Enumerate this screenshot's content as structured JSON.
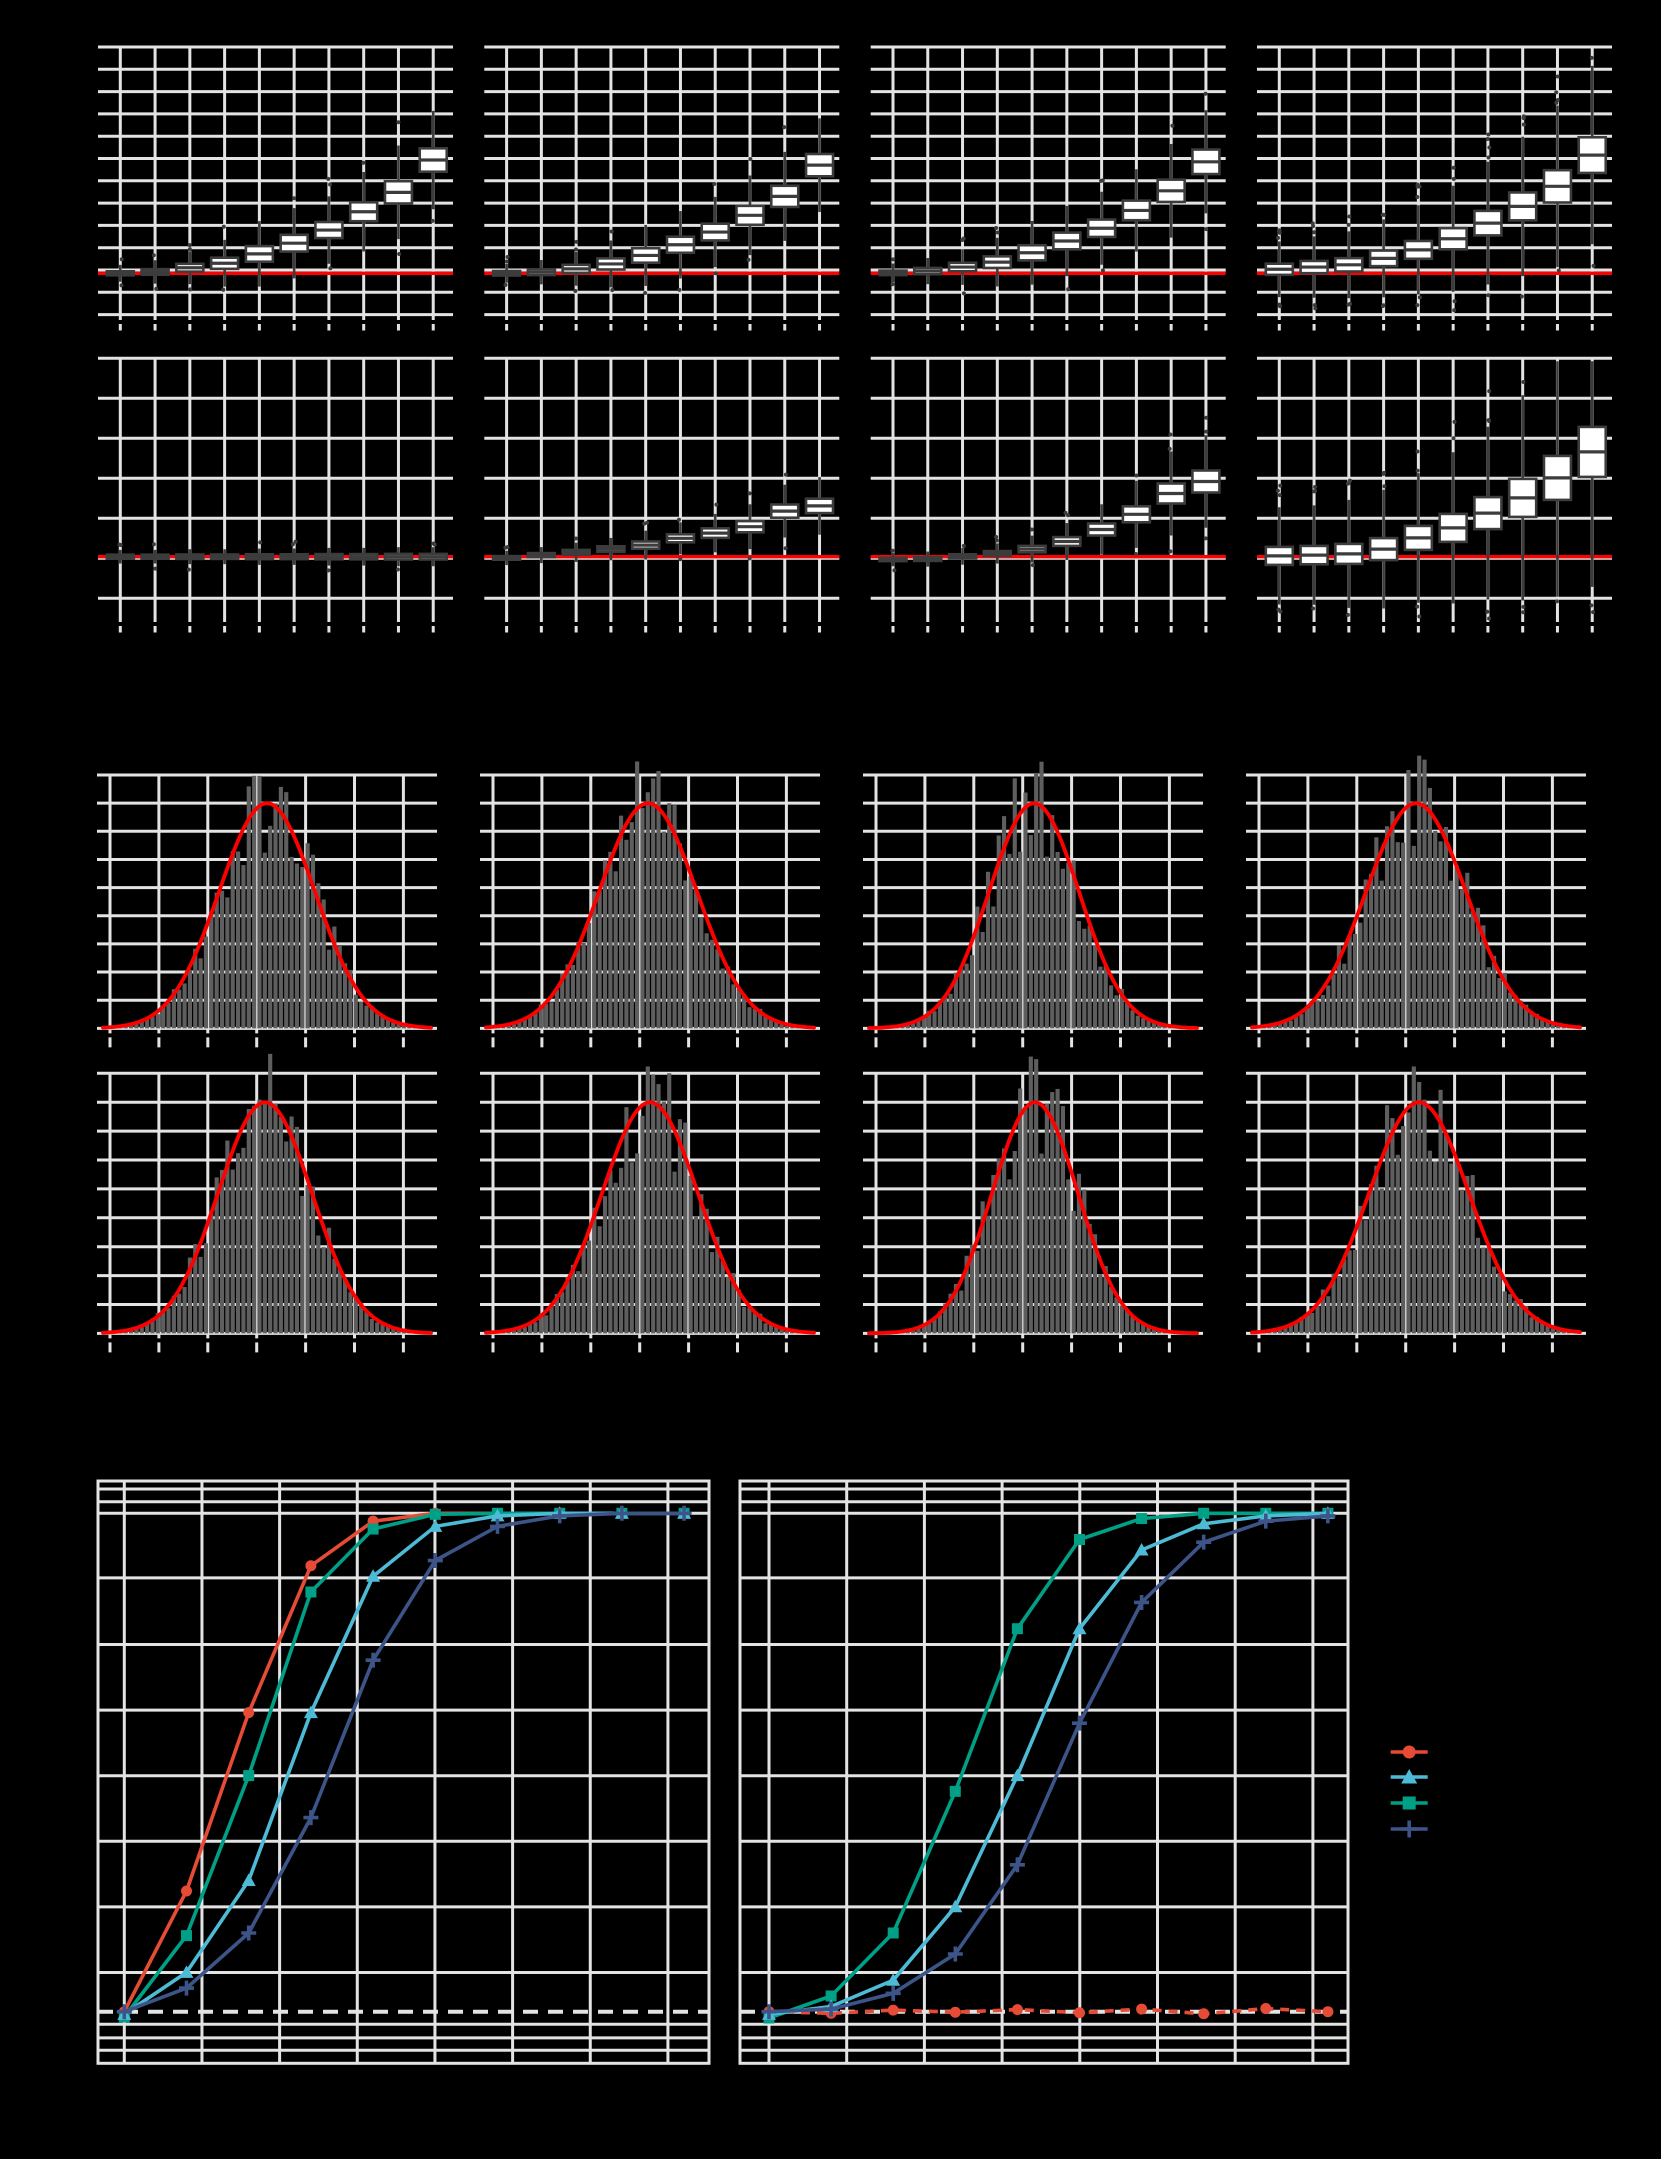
{
  "figure": {
    "background": "#000000",
    "grid_color": "#E3E3E3",
    "reference_red": "#FF0000",
    "box_stroke": "#3C3C3C",
    "box_fill": "#FFFFFF",
    "hist_fill": "#5E5E5E",
    "dashed_reference_color": "#E3E3E3"
  },
  "legend": {
    "position": "right of second power panel",
    "items": [
      {
        "name": "series-red-circle",
        "marker": "circle",
        "color": "#E64B35"
      },
      {
        "name": "series-cyan-triangle",
        "marker": "triangle",
        "color": "#4DBBD5"
      },
      {
        "name": "series-teal-square",
        "marker": "square",
        "color": "#00A087"
      },
      {
        "name": "series-navy-plus",
        "marker": "plus",
        "color": "#3C5488"
      }
    ]
  },
  "chart_data": [
    {
      "type": "table",
      "note": "boxplot facet grid 2x4; y units are panel grid divisions relative to the red reference line (axis text not visible in image)",
      "categories": [
        1,
        2,
        3,
        4,
        5,
        6,
        7,
        8,
        9,
        10
      ],
      "reference_line": 0,
      "panels": [
        {
          "row": 1,
          "col": 1,
          "median": [
            0,
            0.06,
            0.25,
            0.45,
            0.87,
            1.35,
            1.94,
            2.76,
            3.63,
            5.08
          ],
          "iqr": [
            0.18,
            0.25,
            0.35,
            0.5,
            0.7,
            0.75,
            0.72,
            0.85,
            1.0,
            1.05
          ],
          "whisker_factor": 1.6,
          "heavy_outliers": false
        },
        {
          "row": 1,
          "col": 2,
          "median": [
            0,
            0.05,
            0.2,
            0.42,
            0.8,
            1.28,
            1.85,
            2.6,
            3.45,
            4.85
          ],
          "iqr": [
            0.2,
            0.26,
            0.36,
            0.5,
            0.65,
            0.72,
            0.75,
            0.85,
            0.95,
            1.0
          ],
          "whisker_factor": 1.6,
          "heavy_outliers": false
        },
        {
          "row": 1,
          "col": 3,
          "median": [
            0.02,
            0.1,
            0.28,
            0.5,
            0.92,
            1.45,
            2.02,
            2.82,
            3.7,
            5.0
          ],
          "iqr": [
            0.2,
            0.28,
            0.38,
            0.52,
            0.68,
            0.75,
            0.78,
            0.88,
            1.0,
            1.1
          ],
          "whisker_factor": 1.6,
          "heavy_outliers": false
        },
        {
          "row": 1,
          "col": 4,
          "median": [
            0.18,
            0.28,
            0.38,
            0.67,
            1.05,
            1.55,
            2.25,
            3.0,
            3.9,
            5.3
          ],
          "iqr": [
            0.5,
            0.55,
            0.6,
            0.7,
            0.8,
            0.95,
            1.1,
            1.25,
            1.45,
            1.6
          ],
          "whisker_factor": 2.0,
          "heavy_outliers": true
        },
        {
          "row": 2,
          "col": 1,
          "median": [
            0,
            0,
            0,
            0,
            0,
            0,
            0,
            0,
            0,
            0
          ],
          "iqr": [
            0.1,
            0.1,
            0.11,
            0.11,
            0.12,
            0.12,
            0.13,
            0.13,
            0.14,
            0.14
          ],
          "whisker_factor": 1.2,
          "heavy_outliers": false
        },
        {
          "row": 2,
          "col": 2,
          "median": [
            -0.03,
            0.04,
            0.11,
            0.19,
            0.29,
            0.46,
            0.59,
            0.75,
            1.14,
            1.27
          ],
          "iqr": [
            0.09,
            0.1,
            0.12,
            0.14,
            0.18,
            0.2,
            0.24,
            0.28,
            0.33,
            0.36
          ],
          "whisker_factor": 1.5,
          "heavy_outliers": false
        },
        {
          "row": 2,
          "col": 3,
          "median": [
            -0.07,
            -0.06,
            0.01,
            0.08,
            0.19,
            0.38,
            0.68,
            1.06,
            1.58,
            1.88
          ],
          "iqr": [
            0.08,
            0.09,
            0.1,
            0.12,
            0.16,
            0.22,
            0.3,
            0.4,
            0.5,
            0.55
          ],
          "whisker_factor": 1.6,
          "heavy_outliers": false
        },
        {
          "row": 2,
          "col": 4,
          "median": [
            0.02,
            0.04,
            0.07,
            0.19,
            0.47,
            0.72,
            1.09,
            1.47,
            1.97,
            2.62
          ],
          "iqr": [
            0.45,
            0.46,
            0.5,
            0.55,
            0.6,
            0.7,
            0.8,
            0.95,
            1.1,
            1.25
          ],
          "whisker_factor": 2.2,
          "heavy_outliers": true
        }
      ]
    },
    {
      "type": "bar",
      "note": "histogram facet grid 2x4 with red normal density overlay; bell-shaped distributions, peak at second gridline from top (8 grid divisions)",
      "panels": [
        {
          "row": 1,
          "col": 1,
          "center_offset_px": 0,
          "sigma_px": 48,
          "peak_divisions": 8
        },
        {
          "row": 1,
          "col": 2,
          "center_offset_px": -2,
          "sigma_px": 49,
          "peak_divisions": 8
        },
        {
          "row": 1,
          "col": 3,
          "center_offset_px": 1,
          "sigma_px": 45,
          "peak_divisions": 8
        },
        {
          "row": 1,
          "col": 4,
          "center_offset_px": 0,
          "sigma_px": 50,
          "peak_divisions": 8
        },
        {
          "row": 2,
          "col": 1,
          "center_offset_px": -2,
          "sigma_px": 47,
          "peak_divisions": 8
        },
        {
          "row": 2,
          "col": 2,
          "center_offset_px": 0,
          "sigma_px": 48,
          "peak_divisions": 8
        },
        {
          "row": 2,
          "col": 3,
          "center_offset_px": 2,
          "sigma_px": 43,
          "peak_divisions": 8
        },
        {
          "row": 2,
          "col": 4,
          "center_offset_px": 3,
          "sigma_px": 50,
          "peak_divisions": 8
        }
      ]
    },
    {
      "type": "line",
      "note": "two power-curve panels; y from 0 to 1, white dashed reference at 0.05",
      "x": [
        1,
        2,
        3,
        4,
        5,
        6,
        7,
        8,
        9,
        10
      ],
      "ylim": [
        0,
        1
      ],
      "dashed_reference": 0.05,
      "panels": [
        {
          "side": "left",
          "series": [
            {
              "name": "series-red-circle",
              "marker": "circle",
              "color": "#E64B35",
              "dashed": false,
              "values": [
                0.05,
                0.28,
                0.62,
                0.9,
                0.985,
                1,
                1,
                1,
                1,
                1
              ]
            },
            {
              "name": "series-teal-square",
              "marker": "square",
              "color": "#00A087",
              "dashed": false,
              "values": [
                0.04,
                0.195,
                0.5,
                0.85,
                0.97,
                0.998,
                1,
                1,
                1,
                1
              ]
            },
            {
              "name": "series-cyan-triangle",
              "marker": "triangle",
              "color": "#4DBBD5",
              "dashed": false,
              "values": [
                0.045,
                0.125,
                0.3,
                0.62,
                0.88,
                0.975,
                0.995,
                1,
                1,
                1
              ]
            },
            {
              "name": "series-navy-plus",
              "marker": "plus",
              "color": "#3C5488",
              "dashed": false,
              "values": [
                0.05,
                0.095,
                0.2,
                0.42,
                0.72,
                0.91,
                0.975,
                0.995,
                1,
                1
              ]
            }
          ]
        },
        {
          "side": "right",
          "series": [
            {
              "name": "series-red-circle",
              "marker": "circle",
              "color": "#E64B35",
              "dashed": true,
              "values": [
                0.05,
                0.047,
                0.053,
                0.049,
                0.054,
                0.048,
                0.055,
                0.046,
                0.056,
                0.05
              ]
            },
            {
              "name": "series-teal-square",
              "marker": "square",
              "color": "#00A087",
              "dashed": false,
              "values": [
                0.038,
                0.08,
                0.2,
                0.47,
                0.78,
                0.95,
                0.99,
                1,
                1,
                1
              ]
            },
            {
              "name": "series-cyan-triangle",
              "marker": "triangle",
              "color": "#4DBBD5",
              "dashed": false,
              "values": [
                0.045,
                0.06,
                0.11,
                0.25,
                0.5,
                0.78,
                0.93,
                0.98,
                0.995,
                1
              ]
            },
            {
              "name": "series-navy-plus",
              "marker": "plus",
              "color": "#3C5488",
              "dashed": false,
              "values": [
                0.05,
                0.055,
                0.085,
                0.16,
                0.33,
                0.6,
                0.83,
                0.945,
                0.985,
                0.995
              ]
            }
          ]
        }
      ]
    }
  ]
}
